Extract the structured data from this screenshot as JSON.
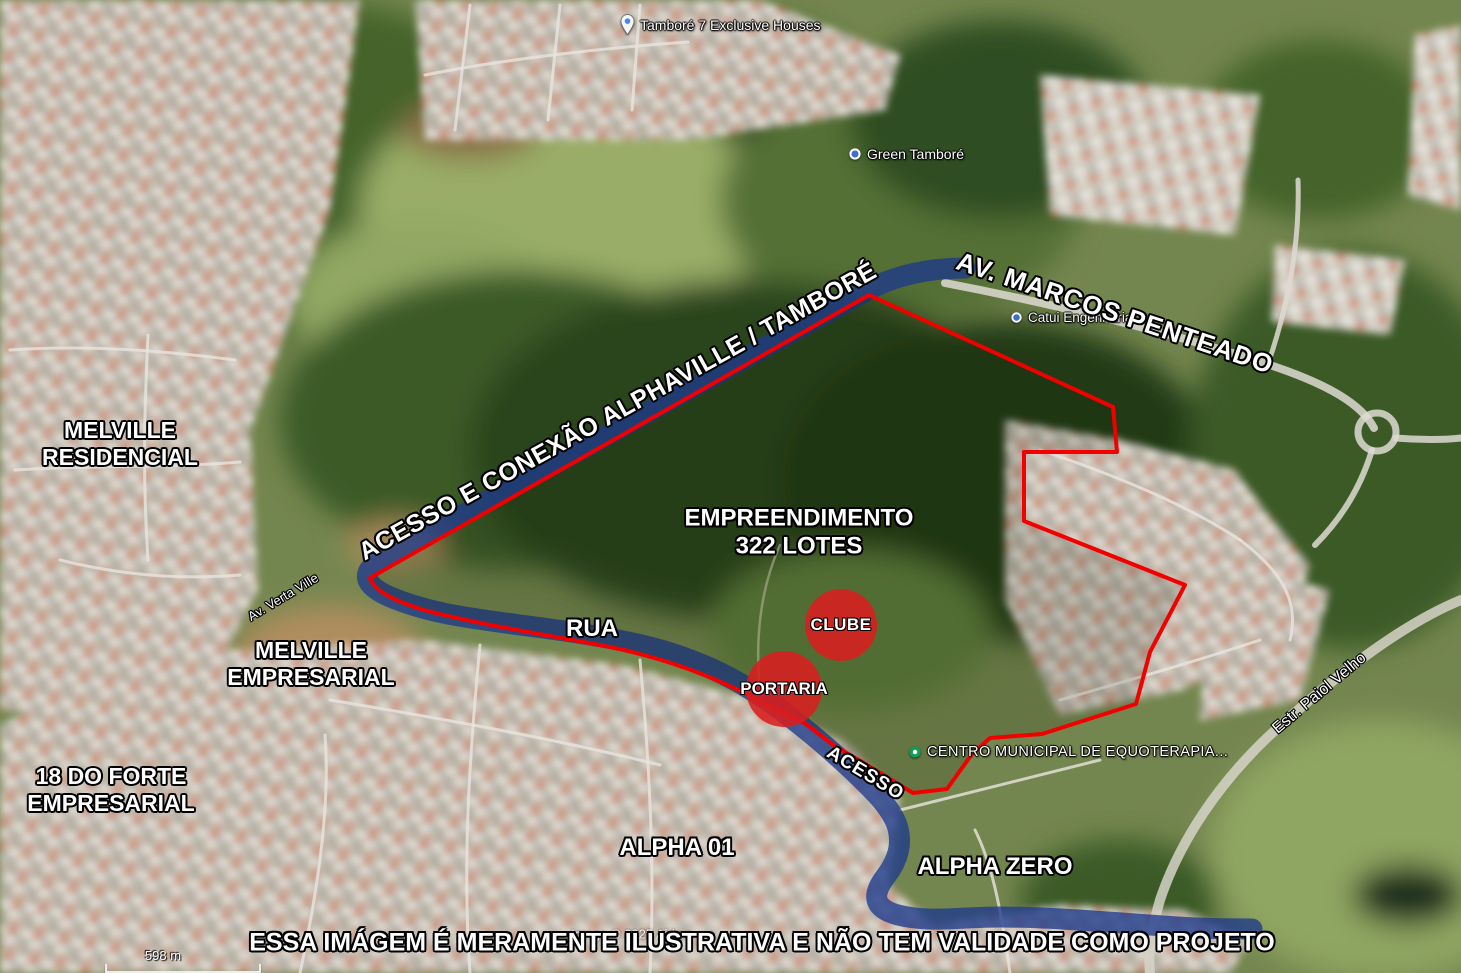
{
  "annotations": {
    "development": {
      "line1": "EMPREENDIMENTO",
      "line2": "322 LOTES"
    },
    "access_route": "ACESSO E CONEXÃO ALPHAVILLE / TAMBORÉ",
    "rua": "RUA",
    "acesso": "ACESSO",
    "clube": "CLUBE",
    "portaria": "PORTARIA",
    "disclaimer": "ESSA IMÁGEM É MERAMENTE ILUSTRATIVA E NÃO TEM VALIDADE COMO PROJETO"
  },
  "districts": {
    "melville_residencial": {
      "line1": "MELVILLE",
      "line2": "RESIDENCIAL"
    },
    "melville_empresarial": {
      "line1": "MELVILLE",
      "line2": "EMPRESARIAL"
    },
    "dezoito_do_forte": {
      "line1": "18 DO FORTE",
      "line2": "EMPRESARIAL"
    },
    "alpha_01": "ALPHA 01",
    "alpha_zero": "ALPHA ZERO"
  },
  "roads": {
    "marcos_penteado": "AV. MARCOS PENTEADO",
    "paiol_velho": "Estr. Paiol Velho",
    "verta_ville": "Av. Verta Ville"
  },
  "places": {
    "tambore7": "Tamboré 7 Exclusive Houses",
    "green_tambore": "Green Tamboré",
    "catui": "Catui Engenharia",
    "equoterapia": "CENTRO MUNICIPAL DE EQUOTERAPIA..."
  },
  "footer": {
    "scale": "598 m",
    "attribution": "Image © 2025 Airbus"
  },
  "colors": {
    "boundary_red": "#f20000",
    "route_blue": "#1d3a8c",
    "marker_red": "#d81f1f"
  }
}
